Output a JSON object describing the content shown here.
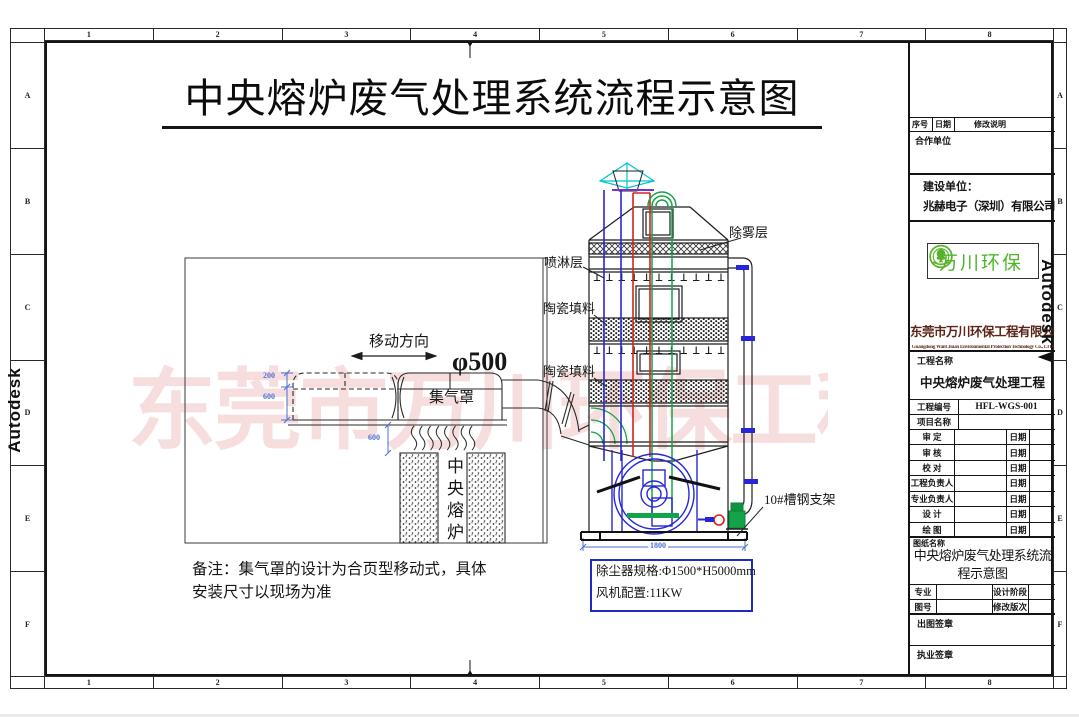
{
  "sheet": {
    "title": "中央熔炉废气处理系统流程示意图",
    "ruler_columns": [
      "1",
      "2",
      "3",
      "4",
      "5",
      "6",
      "7",
      "8"
    ],
    "ruler_rows": [
      "A",
      "B",
      "C",
      "D",
      "E",
      "F"
    ],
    "autodesk_watermark": "Autodesk",
    "company_watermark": "东莞市万川环保工程有限公司"
  },
  "drawing": {
    "labels": {
      "demister": "除雾层",
      "spray_layer": "喷淋层",
      "ceramic_packing_upper": "陶瓷填料",
      "ceramic_packing_lower": "陶瓷填料",
      "move_direction": "移动方向",
      "duct_diameter": "φ500",
      "gas_hood": "集气罩",
      "furnace": "中央熔炉",
      "support": "10#槽钢支架"
    },
    "dimensions": {
      "hood_top": "200",
      "hood_body": "600",
      "hood_clearance": "600",
      "base_width": "1800"
    },
    "note_line1": "备注：集气罩的设计为合页型移动式，具体",
    "note_line2": "安装尺寸以现场为准",
    "spec_box": {
      "line1": "除尘器规格:Φ1500*H5000mm",
      "line2": "风机配置:11KW"
    }
  },
  "title_block": {
    "revision_header": {
      "seq": "序号",
      "date": "日期",
      "desc": "修改说明"
    },
    "partner_label": "合作单位",
    "owner_label": "建设单位：",
    "owner_value": "兆赫电子（深圳）有限公司",
    "logo_text": "万川环保",
    "company_cn": "东莞市万川环保工程有限公司",
    "company_en": "Guangdong WanChuan  Environmental Protection Technology Co., LTD",
    "project_name_label": "工程名称",
    "project_name": "中央熔炉废气处理工程",
    "project_no_label": "工程编号",
    "project_no": "HFL-WGS-001",
    "item_name_label": "项目名称",
    "sign_rows": [
      {
        "label": "审  定",
        "date_label": "日期"
      },
      {
        "label": "审  核",
        "date_label": "日期"
      },
      {
        "label": "校  对",
        "date_label": "日期"
      },
      {
        "label": "工程负责人",
        "date_label": "日期"
      },
      {
        "label": "专业负责人",
        "date_label": "日期"
      },
      {
        "label": "设  计",
        "date_label": "日期"
      },
      {
        "label": "绘  图",
        "date_label": "日期"
      }
    ],
    "drawing_name_label": "图纸名称",
    "drawing_name": "中央熔炉废气处理系统流程示意图",
    "major_label": "专业",
    "stage_label": "设计阶段",
    "sheet_no_label": "图号",
    "rev_label": "修改版次",
    "stamp1_label": "出图签章",
    "stamp2_label": "执业签章"
  }
}
